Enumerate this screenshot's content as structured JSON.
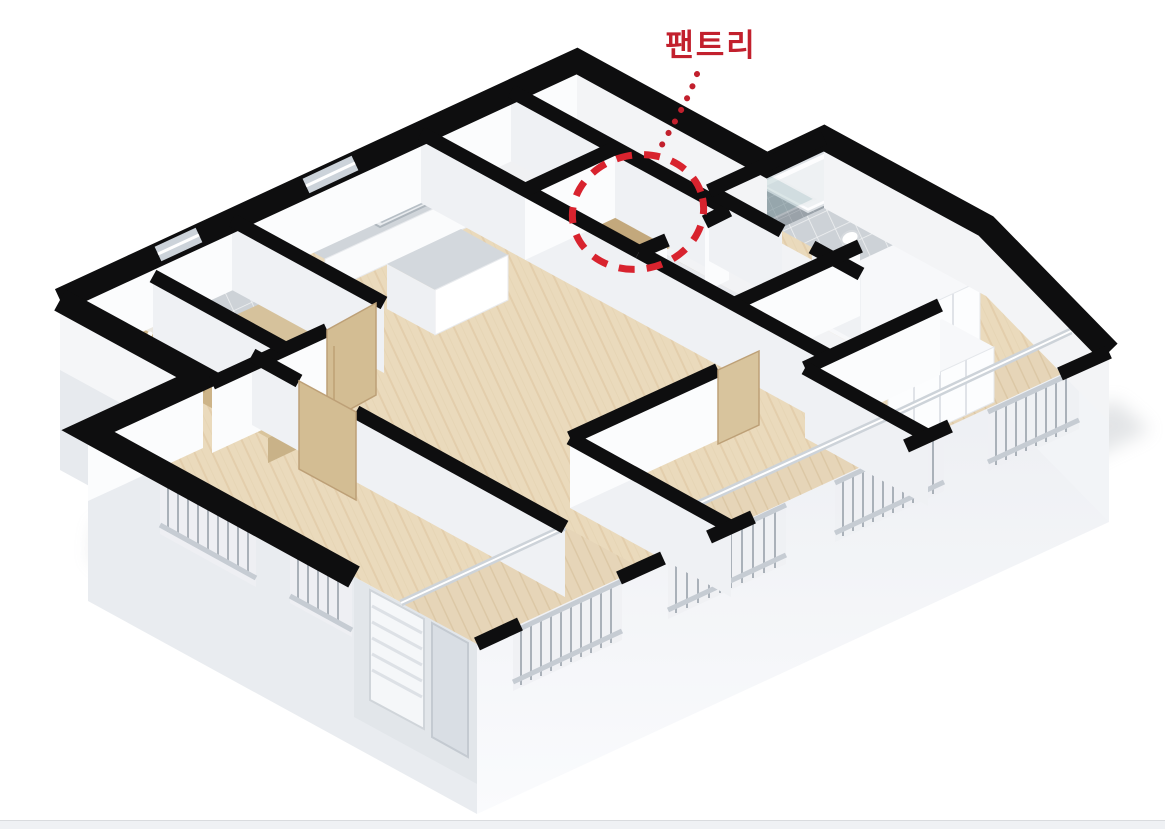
{
  "annotation": {
    "label": "팬트리"
  },
  "scene": {
    "kind": "3d-isometric-apartment-floor-plan-render"
  },
  "colors": {
    "accent_red": "#c2202d",
    "circle_red": "#d8232e",
    "wall_black": "#0e0e0f",
    "wood_floor": "#eadabc",
    "balcony_wood": "#e6d5b8",
    "tile_gray": "#cdd2d7",
    "dark_tile": "#9aa2a9",
    "slab_face": "#e9ecf0",
    "counter_gray": "#d0d5da",
    "cabinet_wood": "#d9c49c",
    "railing_gray": "#aab1b9",
    "background": "#ffffff",
    "footer_strip": "#eff1f4"
  }
}
